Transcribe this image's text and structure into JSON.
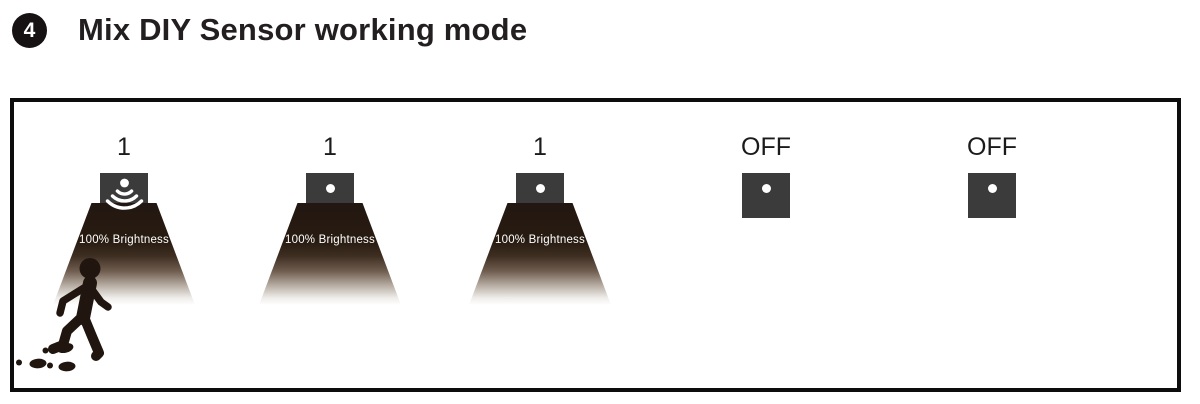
{
  "header": {
    "badge": "4",
    "title": "Mix DIY Sensor working mode"
  },
  "panel": {
    "units": [
      {
        "label": "1",
        "state": "motion-detected-light-on",
        "brightness": "100% Brightness"
      },
      {
        "label": "1",
        "state": "light-on",
        "brightness": "100% Brightness"
      },
      {
        "label": "1",
        "state": "light-on",
        "brightness": "100% Brightness"
      },
      {
        "label": "OFF",
        "state": "light-off"
      },
      {
        "label": "OFF",
        "state": "light-off"
      }
    ]
  },
  "colors": {
    "ink": "#231f20",
    "fixture_gray": "#3b3b3c",
    "cone_dark": "#221711",
    "cone_text": "#ffffff"
  }
}
